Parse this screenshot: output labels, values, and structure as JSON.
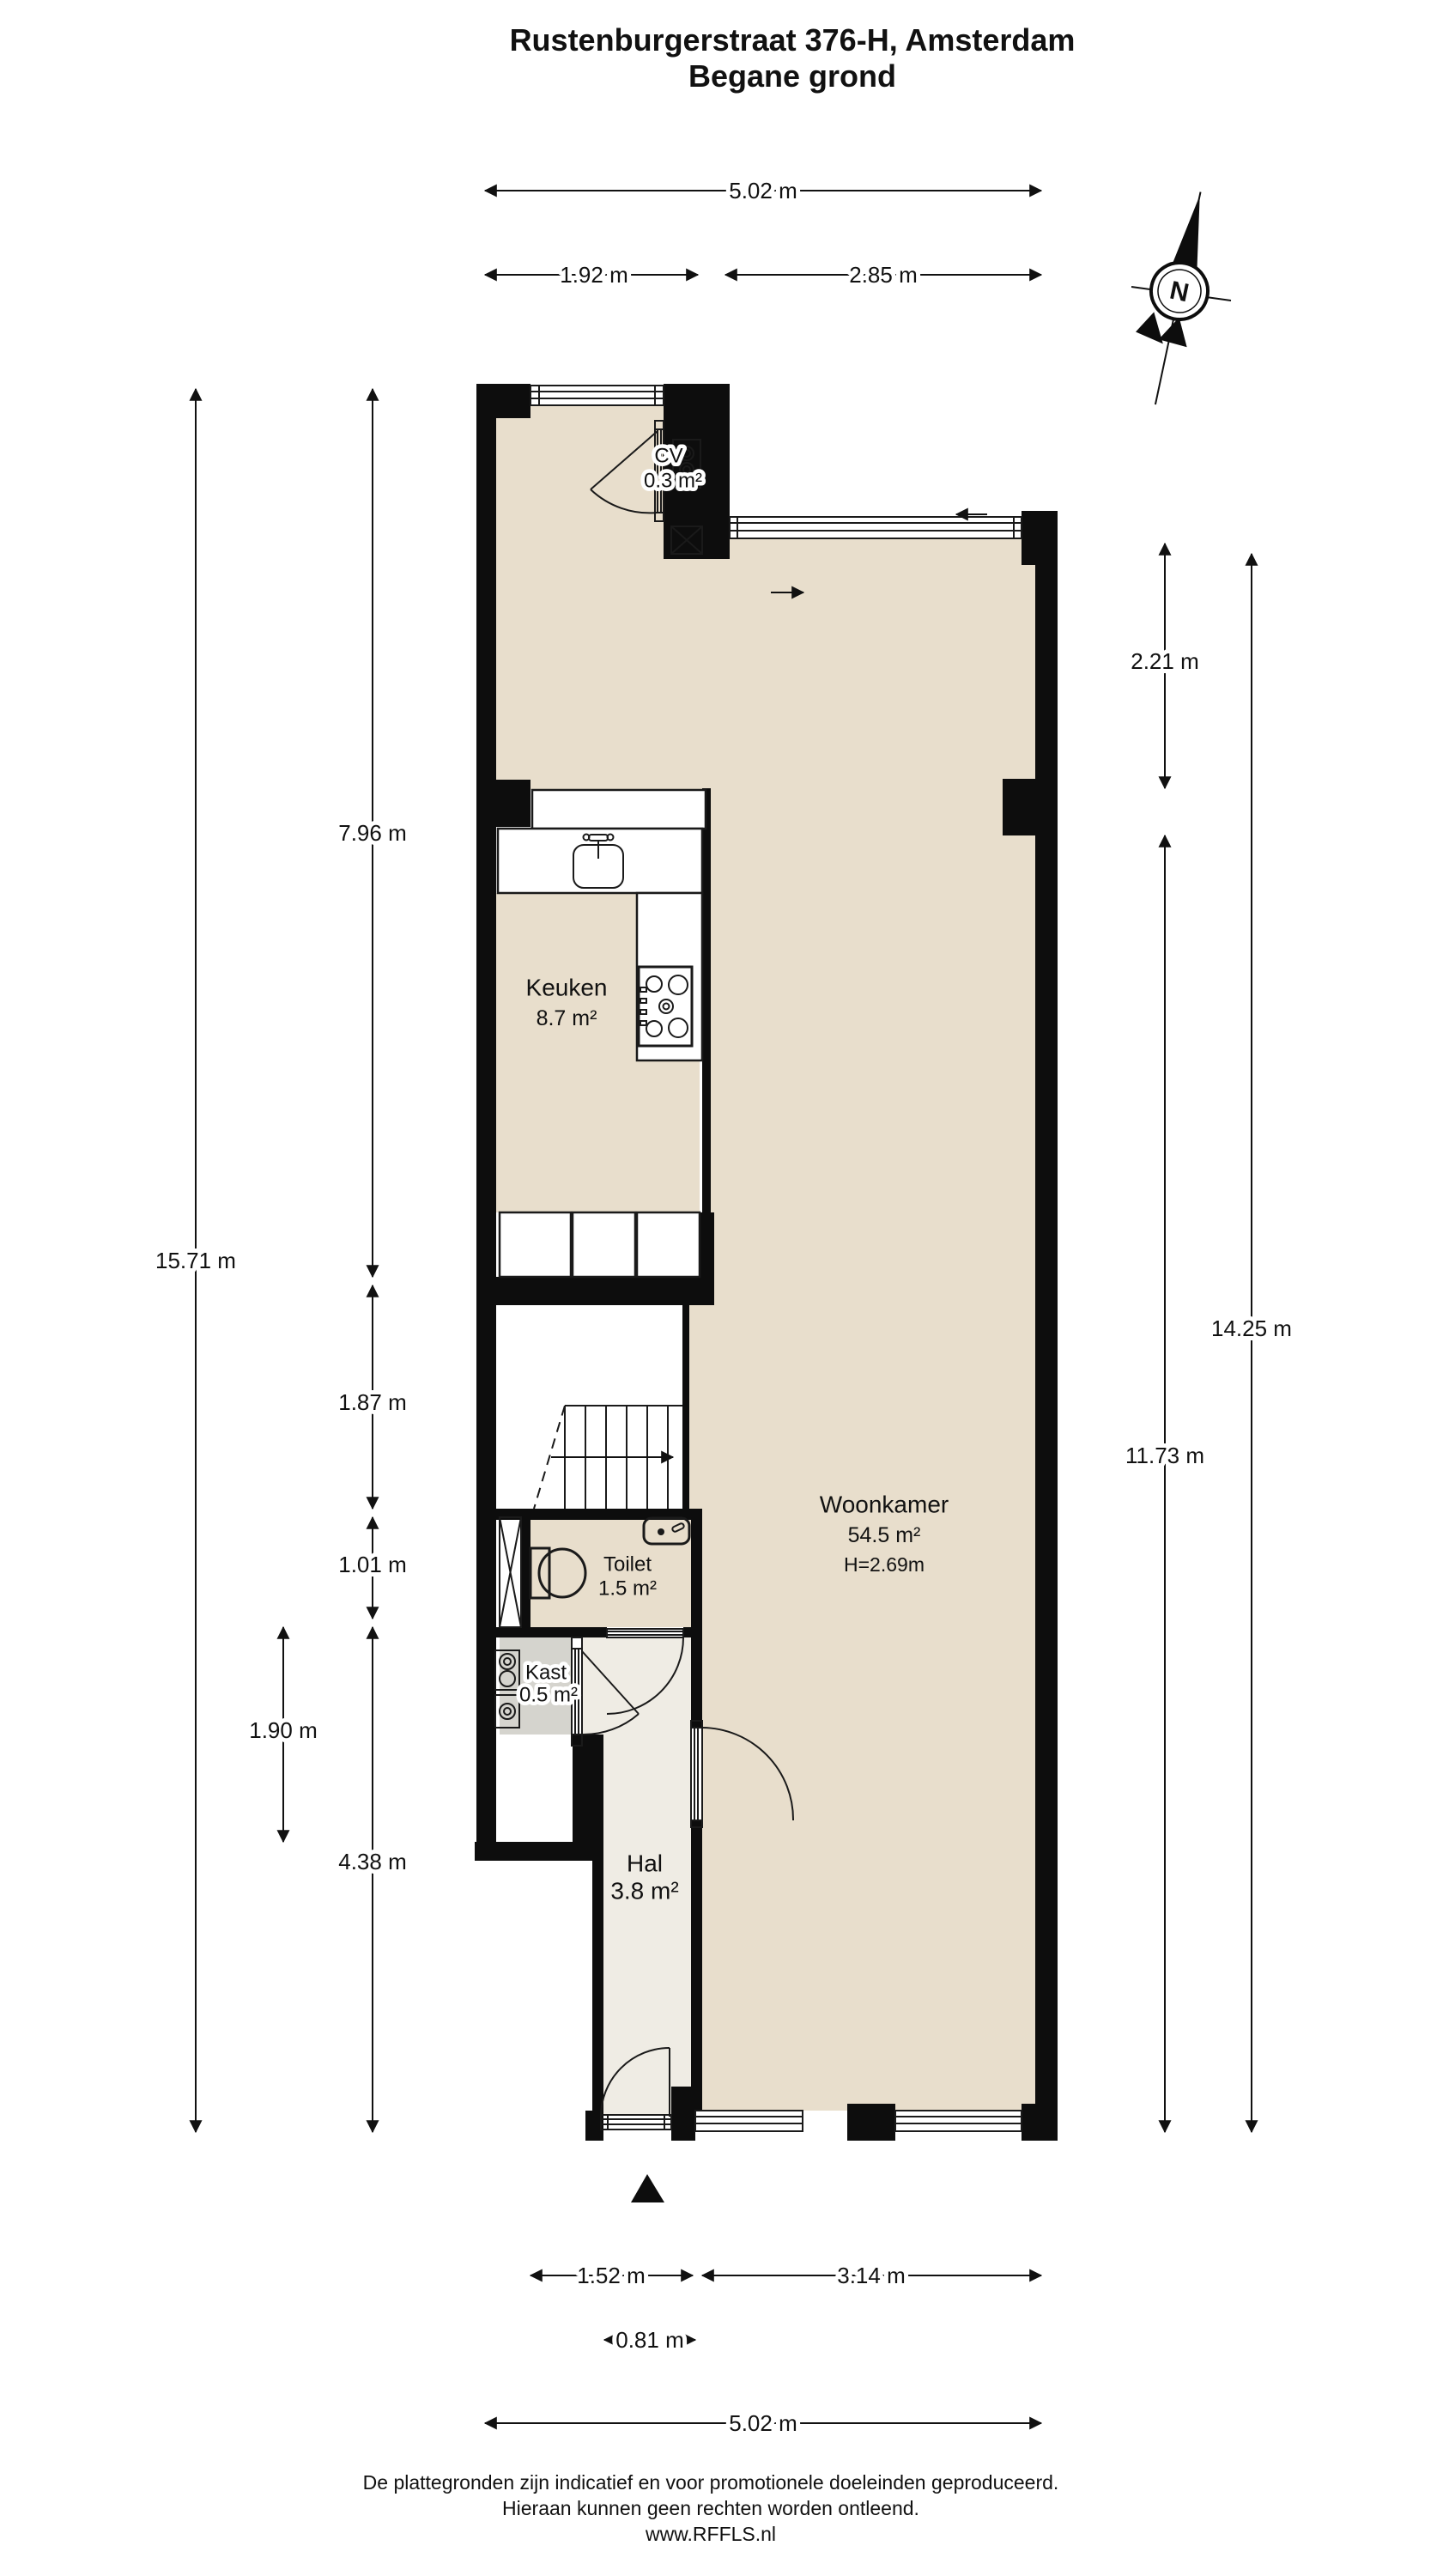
{
  "title": {
    "line1": "Rustenburgerstraat 376-H, Amsterdam",
    "line2": "Begane grond"
  },
  "compass": {
    "label": "N"
  },
  "rooms": {
    "keuken": {
      "name": "Keuken",
      "area": "8.7 m²"
    },
    "woonkamer": {
      "name": "Woonkamer",
      "area": "54.5 m²",
      "ceiling_height": "H=2.69m"
    },
    "toilet": {
      "name": "Toilet",
      "area": "1.5 m²"
    },
    "kast": {
      "name": "Kast",
      "area": "0.5 m²"
    },
    "hal": {
      "name": "Hal",
      "area": "3.8 m²"
    },
    "cv": {
      "name": "CV",
      "area": "0.3 m²"
    }
  },
  "dimensions": {
    "top_total": "5.02 m",
    "top_left": "1.92 m",
    "top_right": "2.85 m",
    "left_total": "15.71 m",
    "left_upper": "7.96 m",
    "left_stairs": "1.87 m",
    "left_toilet": "1.01 m",
    "left_kast": "1.90 m",
    "left_lower": "4.38 m",
    "right_upper": "2.21 m",
    "right_lower": "11.73 m",
    "right_total": "14.25 m",
    "bottom_hal": "1.52 m",
    "bottom_window": "3.14 m",
    "bottom_door": "0.81 m",
    "bottom_total": "5.02 m"
  },
  "footer": {
    "line1": "De plattegronden zijn indicatief en voor promotionele doeleinden geproduceerd.",
    "line2": "Hieraan kunnen geen rechten worden ontleend.",
    "line3": "www.RFFLS.nl"
  },
  "colors": {
    "wall": "#0d0d0d",
    "floor": "#e8decc",
    "floor_hall": "#efece4",
    "closet_gray": "#d5d4ce",
    "line": "#1a1a1a"
  }
}
